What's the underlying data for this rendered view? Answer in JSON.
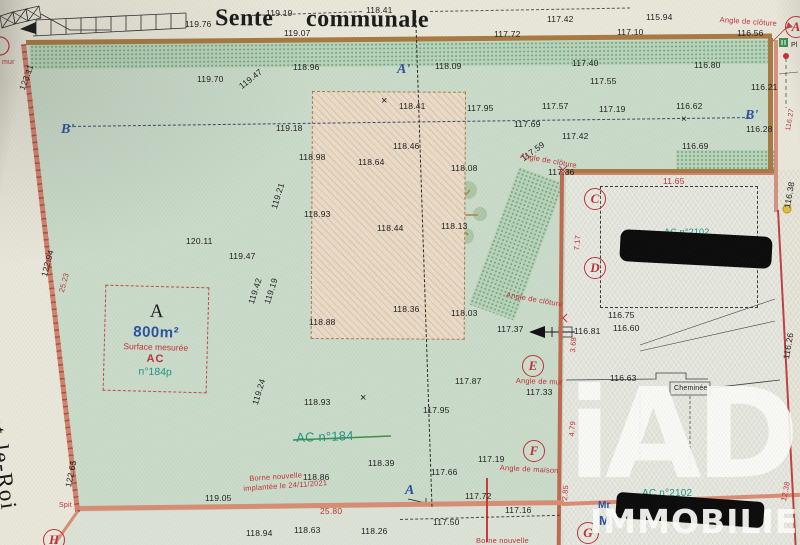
{
  "street": {
    "top": "Sente communale",
    "left": "de Nogent-le-Roi"
  },
  "parcel_box": {
    "letter": "A",
    "area": "800m²",
    "surface": "Surface mesurée",
    "section": "AC",
    "number": "n°184p"
  },
  "watermark": {
    "brand": "iAD",
    "subtitle": "IMMOBILIER"
  },
  "colors": {
    "boundary_brown": "#a87a42",
    "boundary_pink": "#d4826e",
    "annotation_red": "#c03038",
    "point_blue": "#2a52a0",
    "parcel_teal": "#1f9486",
    "green_area": "#cbdccb"
  },
  "circled_points": [
    {
      "t": "C",
      "x": 584,
      "y": 188
    },
    {
      "t": "D",
      "x": 584,
      "y": 257
    },
    {
      "t": "E",
      "x": 522,
      "y": 355
    },
    {
      "t": "F",
      "x": 523,
      "y": 440
    },
    {
      "t": "G",
      "x": 577,
      "y": 522
    },
    {
      "t": "H",
      "x": 43,
      "y": 529
    },
    {
      "t": "A",
      "x": 785,
      "y": 16
    }
  ],
  "section_points": [
    {
      "t": "A'",
      "x": 397,
      "y": 62
    },
    {
      "t": "B'",
      "x": 61,
      "y": 122
    },
    {
      "t": "B'",
      "x": 745,
      "y": 108
    },
    {
      "t": "A",
      "x": 405,
      "y": 483
    }
  ],
  "labels": [
    {
      "t": "119.19",
      "x": 266,
      "y": 8
    },
    {
      "t": "118.41",
      "x": 366,
      "y": 5
    },
    {
      "t": "119.76",
      "x": 185,
      "y": 19
    },
    {
      "t": "119.07",
      "x": 284,
      "y": 28
    },
    {
      "t": "117.42",
      "x": 547,
      "y": 14
    },
    {
      "t": "115.94",
      "x": 646,
      "y": 12
    },
    {
      "t": "117.72",
      "x": 494,
      "y": 29
    },
    {
      "t": "117.10",
      "x": 617,
      "y": 27
    },
    {
      "t": "116.56",
      "x": 737,
      "y": 28
    },
    {
      "t": "118.96",
      "x": 293,
      "y": 62
    },
    {
      "t": "119.70",
      "x": 197,
      "y": 74
    },
    {
      "t": "119.47",
      "x": 237,
      "y": 83,
      "rot": -38
    },
    {
      "t": "118.09",
      "x": 435,
      "y": 61
    },
    {
      "t": "117.40",
      "x": 572,
      "y": 58
    },
    {
      "t": "116.80",
      "x": 694,
      "y": 60
    },
    {
      "t": "117.55",
      "x": 590,
      "y": 76
    },
    {
      "t": "116.21",
      "x": 751,
      "y": 82
    },
    {
      "t": "119.18",
      "x": 276,
      "y": 123
    },
    {
      "t": "118.41",
      "x": 399,
      "y": 101
    },
    {
      "t": "×",
      "x": 381,
      "y": 95,
      "fs": 11
    },
    {
      "t": "117.95",
      "x": 467,
      "y": 103
    },
    {
      "t": "117.57",
      "x": 542,
      "y": 101
    },
    {
      "t": "117.19",
      "x": 599,
      "y": 104
    },
    {
      "t": "116.62",
      "x": 676,
      "y": 101
    },
    {
      "t": "×",
      "x": 681,
      "y": 114,
      "fs": 10
    },
    {
      "t": "116.28",
      "x": 746,
      "y": 124
    },
    {
      "t": "117.69",
      "x": 514,
      "y": 119
    },
    {
      "t": "117.42",
      "x": 562,
      "y": 131
    },
    {
      "t": "116.69",
      "x": 682,
      "y": 141
    },
    {
      "t": "118.98",
      "x": 299,
      "y": 152
    },
    {
      "t": "118.46",
      "x": 393,
      "y": 141
    },
    {
      "t": "118.64",
      "x": 358,
      "y": 157
    },
    {
      "t": "118.08",
      "x": 451,
      "y": 163
    },
    {
      "t": "117.59",
      "x": 519,
      "y": 155,
      "rot": -36
    },
    {
      "t": "117.36",
      "x": 548,
      "y": 167
    },
    {
      "t": "118.93",
      "x": 304,
      "y": 209
    },
    {
      "t": "118.44",
      "x": 377,
      "y": 223
    },
    {
      "t": "118.13",
      "x": 441,
      "y": 221
    },
    {
      "t": "120.11",
      "x": 186,
      "y": 236
    },
    {
      "t": "119.47",
      "x": 229,
      "y": 251
    },
    {
      "t": "119.21",
      "x": 269,
      "y": 207,
      "rot": -73
    },
    {
      "t": "123.11",
      "x": 17,
      "y": 88,
      "rot": -70
    },
    {
      "t": "122.94",
      "x": 39,
      "y": 275,
      "rot": -75
    },
    {
      "t": "119.42",
      "x": 246,
      "y": 302,
      "rot": -72
    },
    {
      "t": "119.19",
      "x": 262,
      "y": 302,
      "rot": -72
    },
    {
      "t": "119.24",
      "x": 250,
      "y": 403,
      "rot": -73
    },
    {
      "t": "122.65",
      "x": 63,
      "y": 486,
      "rot": -78
    },
    {
      "t": "118.88",
      "x": 309,
      "y": 317
    },
    {
      "t": "118.36",
      "x": 393,
      "y": 304
    },
    {
      "t": "118.03",
      "x": 451,
      "y": 308
    },
    {
      "t": "117.37",
      "x": 497,
      "y": 324
    },
    {
      "t": "116.81",
      "x": 574,
      "y": 326
    },
    {
      "t": "116.75",
      "x": 608,
      "y": 310
    },
    {
      "t": "116.60",
      "x": 613,
      "y": 323
    },
    {
      "t": "116.63",
      "x": 610,
      "y": 373
    },
    {
      "t": "117.87",
      "x": 455,
      "y": 376
    },
    {
      "t": "117.33",
      "x": 526,
      "y": 387
    },
    {
      "t": "118.93",
      "x": 304,
      "y": 397
    },
    {
      "t": "×",
      "x": 360,
      "y": 392,
      "fs": 11
    },
    {
      "t": "117.95",
      "x": 423,
      "y": 405
    },
    {
      "t": "118.39",
      "x": 368,
      "y": 458
    },
    {
      "t": "118.86",
      "x": 303,
      "y": 472
    },
    {
      "t": "117.66",
      "x": 431,
      "y": 467
    },
    {
      "t": "117.19",
      "x": 478,
      "y": 454
    },
    {
      "t": "117.72",
      "x": 465,
      "y": 491
    },
    {
      "t": "117.16",
      "x": 505,
      "y": 505
    },
    {
      "t": "117.50",
      "x": 433,
      "y": 517
    },
    {
      "t": "119.05",
      "x": 205,
      "y": 493
    },
    {
      "t": "118.94",
      "x": 246,
      "y": 528
    },
    {
      "t": "118.63",
      "x": 294,
      "y": 525
    },
    {
      "t": "118.26",
      "x": 361,
      "y": 526
    },
    {
      "t": "116.38",
      "x": 782,
      "y": 207,
      "rot": -80
    },
    {
      "t": "116.26",
      "x": 781,
      "y": 358,
      "rot": -80
    },
    {
      "t": "Cheminée",
      "x": 674,
      "y": 385,
      "fs": 7
    },
    {
      "t": "Pl",
      "x": 791,
      "y": 42,
      "fs": 7
    },
    {
      "t": "Angle de clôture",
      "x": 720,
      "y": 15,
      "rot": 4,
      "cl": "r"
    },
    {
      "t": "Angle de clôture",
      "x": 521,
      "y": 151,
      "rot": 10,
      "cl": "r"
    },
    {
      "t": "Angle de clôture",
      "x": 507,
      "y": 290,
      "rot": 10,
      "cl": "r"
    },
    {
      "t": "Angle de mur",
      "x": 516,
      "y": 376,
      "rot": 2,
      "cl": "r"
    },
    {
      "t": "Angle de maison",
      "x": 500,
      "y": 463,
      "rot": 3,
      "cl": "r"
    },
    {
      "t": "11.65",
      "x": 663,
      "y": 176,
      "cl": "r",
      "fs": 8.5
    },
    {
      "t": "7.17",
      "x": 572,
      "y": 250,
      "rot": -85,
      "cl": "r"
    },
    {
      "t": "3.68",
      "x": 568,
      "y": 352,
      "rot": -85,
      "cl": "r"
    },
    {
      "t": "4.79",
      "x": 567,
      "y": 436,
      "rot": -85,
      "cl": "r"
    },
    {
      "t": "2.85",
      "x": 560,
      "y": 500,
      "rot": -85,
      "cl": "r"
    },
    {
      "t": "12.38",
      "x": 779,
      "y": 500,
      "rot": -78,
      "cl": "r"
    },
    {
      "t": "116.27",
      "x": 785,
      "y": 130,
      "rot": -80,
      "cl": "r",
      "fs": 7
    },
    {
      "t": "25.23",
      "x": 57,
      "y": 291,
      "rot": -75,
      "cl": "r"
    },
    {
      "t": "25.80",
      "x": 320,
      "y": 506,
      "cl": "r",
      "fs": 8.5
    },
    {
      "t": "mur",
      "x": 2,
      "y": 59,
      "cl": "r",
      "fs": 7
    },
    {
      "t": "Spit",
      "x": 59,
      "y": 502,
      "cl": "r",
      "fs": 7
    },
    {
      "t": "Borne nouvelle",
      "x": 249,
      "y": 474,
      "rot": -4,
      "cl": "r"
    },
    {
      "t": "implantée le 24/11/2021",
      "x": 243,
      "y": 484,
      "rot": -4,
      "cl": "r"
    },
    {
      "t": "Borne nouvelle",
      "x": 476,
      "y": 536,
      "cl": "r"
    },
    {
      "t": "AC n°184",
      "x": 296,
      "y": 430,
      "cl": "t",
      "fs": 13,
      "rot": -2
    },
    {
      "t": "AC n°2102",
      "x": 642,
      "y": 488,
      "cl": "t",
      "fs": 10
    },
    {
      "t": "AC n°2102",
      "x": 664,
      "y": 227,
      "cl": "t",
      "fs": 9
    },
    {
      "t": "Mr",
      "x": 598,
      "y": 500,
      "cl": "bl",
      "fs": 10
    },
    {
      "t": "M",
      "x": 599,
      "y": 513,
      "cl": "bl",
      "fs": 13
    }
  ]
}
